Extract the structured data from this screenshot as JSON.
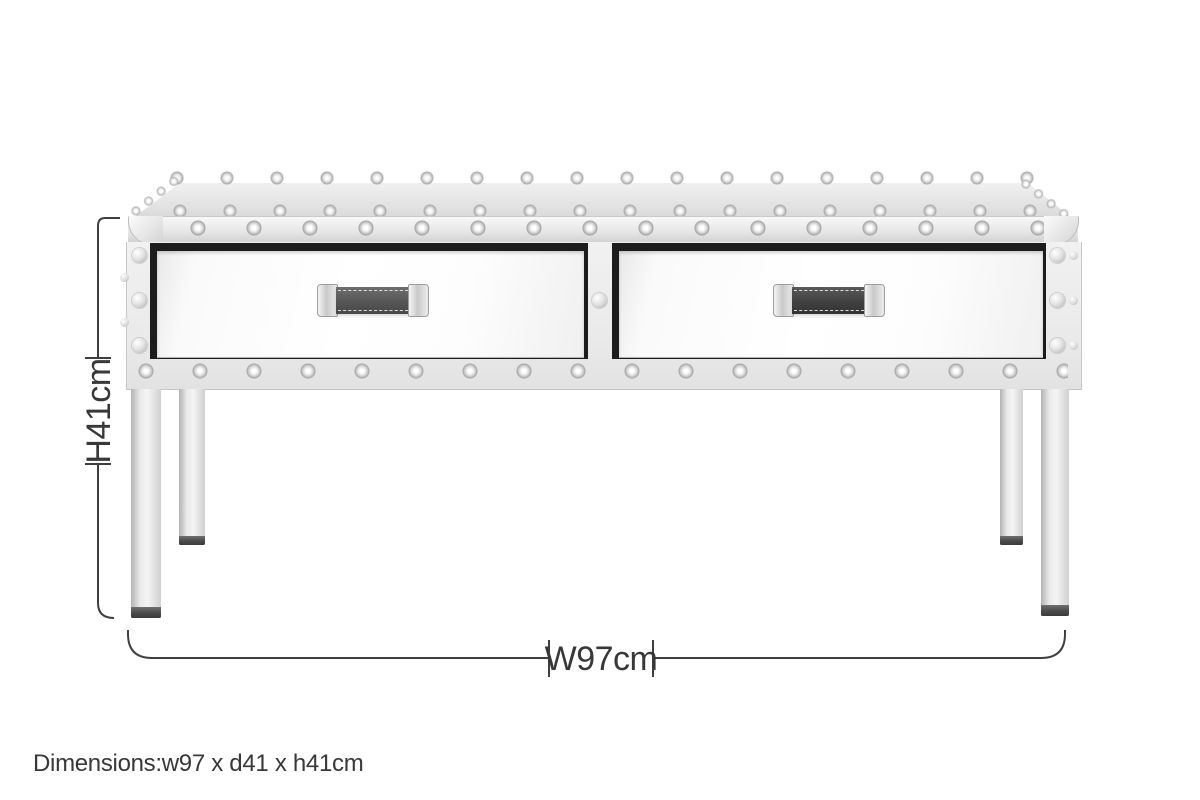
{
  "labels": {
    "height": "H41cm",
    "width": "W97cm",
    "dimensions_caption": "Dimensions:w97 x d41 x h41cm"
  },
  "style": {
    "dimension_line_color": "#3f3f3f",
    "text_color": "#383838",
    "background_color": "#ffffff",
    "chrome_light": "#f4f4f4",
    "chrome_dark": "#c9c9c9",
    "drawer_mirror_color": "#ffffff",
    "drawer_opening_color": "#1c1c1c",
    "handle_strap_color": "#4e4e4e",
    "leg_foot_color": "#4a4a4a"
  }
}
